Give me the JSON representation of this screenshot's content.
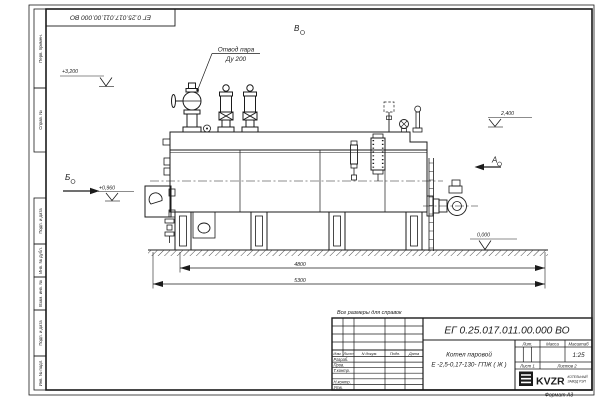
{
  "colors": {
    "line": "#1b1b1b",
    "paper": "#ffffff"
  },
  "top_stamp": {
    "doc_number": "ЕГ 0.25.017.011.00.000  ВО"
  },
  "margin_stamps": [
    "Перв. примен.",
    "Справ. №",
    "Подп. и дата",
    "Инв. № дубл.",
    "Взам. инв. №",
    "Подп. и дата",
    "Инв. № подл."
  ],
  "drawing": {
    "labels": {
      "steam_outlet_line1": "Отвод пара",
      "steam_outlet_line2": "Ду 200",
      "view_top": "В",
      "view_left": "Б",
      "view_right": "А",
      "level_top": "+3,200",
      "level_left": "+0,960",
      "level_right": "2,400",
      "level_ground": "0,000",
      "dim_inner": "4800",
      "dim_outer": "5300"
    }
  },
  "note": "Все размеры для справок",
  "title_block": {
    "doc_number": "ЕГ 0.25.017.011.00.000  ВО",
    "product_line1": "Котел паровой",
    "product_line2": "Е -2,5-0,17-130- ГПЖ ( Ж )",
    "header_cols": [
      "Изм.",
      "Лист",
      "N докум.",
      "Подп.",
      "Дата"
    ],
    "sign_rows": [
      "Разраб.",
      "Пров.",
      "Т.контр.",
      "",
      "Н.контр.",
      "Утв."
    ],
    "lit_label": "Лит.",
    "mass_label": "Масса",
    "scale_label": "Масштаб",
    "scale_value": "1:25",
    "sheet_cell": "Лист  1",
    "sheets_cell": "Листов  2",
    "logo": {
      "name": "KVZR",
      "sub1": "КОТЕЛЬНЫЙ",
      "sub2": "ЗАВОД РЭП"
    },
    "format_note": "Формат А3"
  }
}
